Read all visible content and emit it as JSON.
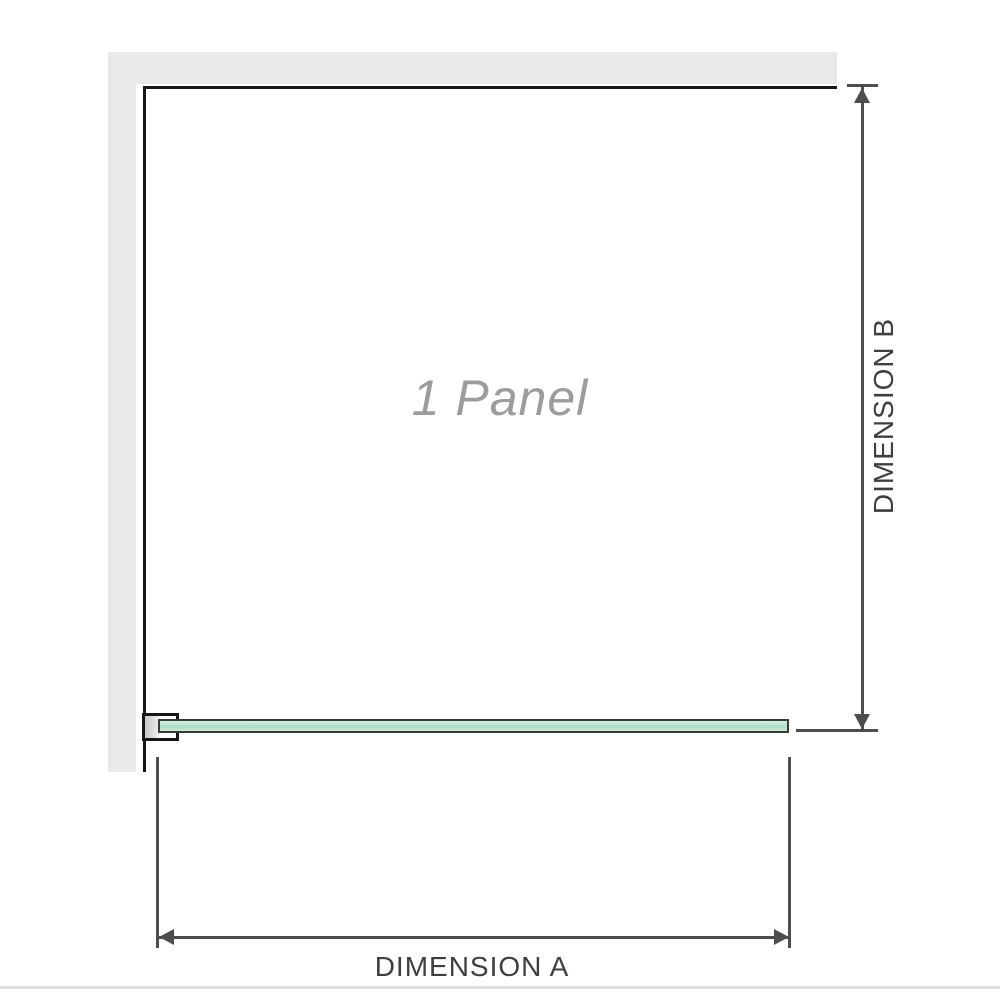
{
  "diagram": {
    "panel_label": "1 Panel",
    "dimension_a_label": "DIMENSION A",
    "dimension_b_label": "DIMENSION B",
    "colors": {
      "wall": "#e9e9e9",
      "outline": "#161616",
      "glass_border": "#3a3a3a",
      "glass_fill_top": "#d9f1e3",
      "glass_fill_mid": "#b2e2c5",
      "glass_fill_bottom": "#ccecd9",
      "dimension": "#4d4d4d",
      "dimension_text": "#3f3f3f",
      "panel_text": "#9c9c9c",
      "floor_line": "#e1e1e1"
    }
  }
}
